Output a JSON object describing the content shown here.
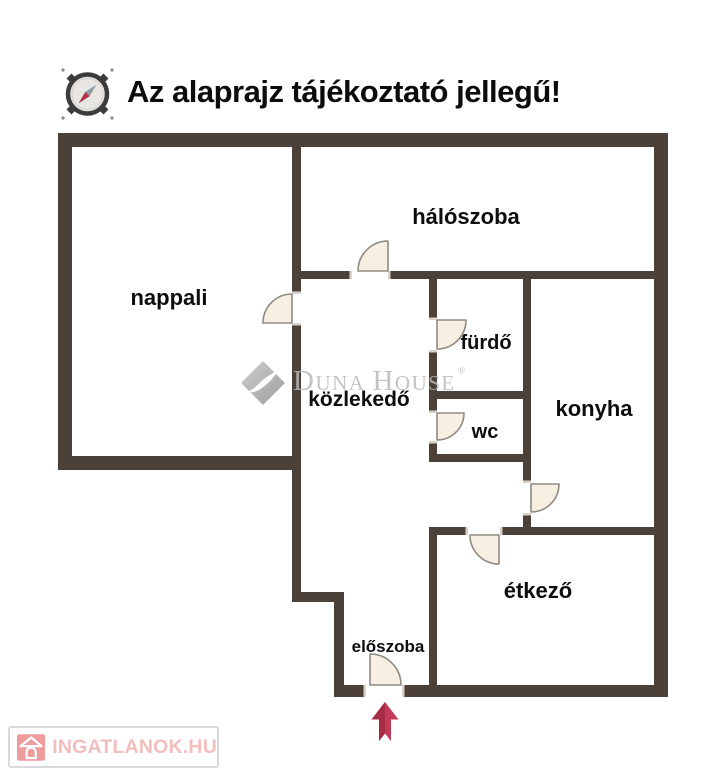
{
  "title": {
    "text": "Az alaprajz tájékoztató jellegű!"
  },
  "rooms": [
    {
      "id": "nappali",
      "label": "nappali"
    },
    {
      "id": "haloszoba",
      "label": "hálószoba"
    },
    {
      "id": "furdo",
      "label": "fürdő"
    },
    {
      "id": "wc",
      "label": "wc"
    },
    {
      "id": "konyha",
      "label": "konyha"
    },
    {
      "id": "kozlekedo",
      "label": "közlekedő"
    },
    {
      "id": "etkezo",
      "label": "étkező"
    },
    {
      "id": "eloszoba",
      "label": "előszoba"
    }
  ],
  "watermark": {
    "duna_initial": "D",
    "duna_rest": "UNA",
    "house_initial": "H",
    "house_rest": "OUSE",
    "registered": "®"
  },
  "footer_logo": {
    "text": "INGATLANOK.HU"
  },
  "icons": {
    "compass": "compass-icon",
    "watermark_diamond": "diamond-logo-icon",
    "entrance_arrow": "entrance-arrow-up-icon",
    "footer_house": "house-icon"
  },
  "colors": {
    "wall": "#4c4138",
    "door_fill": "#f8efe3",
    "door_stroke": "#8f8a82",
    "label": "#0d0d0d",
    "arrow_red": "#c23a56",
    "watermark_gray": "#b9b9b9",
    "logo_text_pink": "#f2bdbd",
    "logo_icon_pink": "#ee9c9c"
  }
}
